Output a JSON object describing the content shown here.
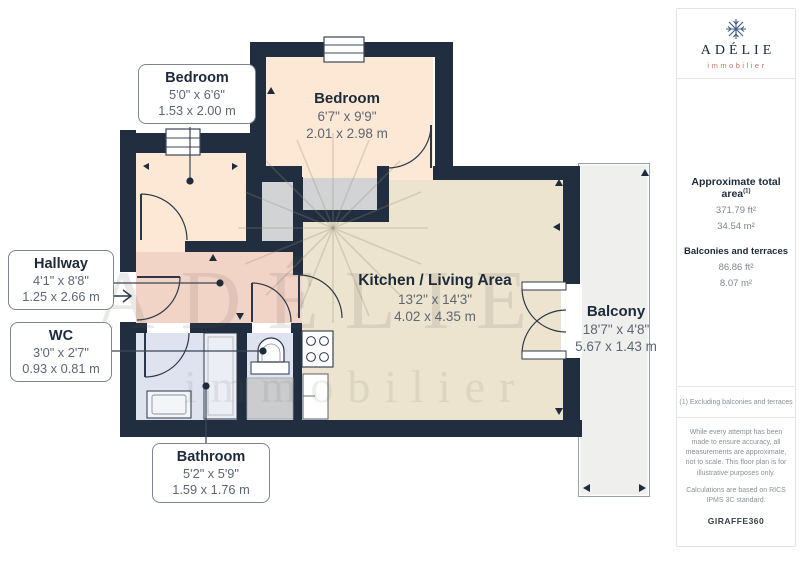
{
  "logo": {
    "name": "ADÉLIE",
    "sub": "immobilier"
  },
  "sidebar": {
    "total_area_label": "Approximate total area",
    "total_area_marker": "(1)",
    "total_area_ft": "371.79 ft²",
    "total_area_m": "34.54 m²",
    "balconies_label": "Balconies and terraces",
    "balconies_ft": "86.86 ft²",
    "balconies_m": "8.07 m²",
    "footnote": "(1) Excluding balconies and terraces",
    "disclaimer1": "While every attempt has been made to ensure accuracy, all measurements are approximate, not to scale. This floor plan is for illustrative purposes only.",
    "disclaimer2": "Calculations are based on RICS IPMS 3C standard.",
    "brand": "GIRAFFE",
    "brand_suffix": "360"
  },
  "rooms": {
    "bedroom1": {
      "name": "Bedroom",
      "imperial": "5'0\" x 6'6\"",
      "metric": "1.53 x 2.00 m"
    },
    "bedroom2": {
      "name": "Bedroom",
      "imperial": "6'7\" x 9'9\"",
      "metric": "2.01 x 2.98 m"
    },
    "hallway": {
      "name": "Hallway",
      "imperial": "4'1\" x 8'8\"",
      "metric": "1.25 x 2.66 m"
    },
    "wc": {
      "name": "WC",
      "imperial": "3'0\" x 2'7\"",
      "metric": "0.93 x 0.81 m"
    },
    "kitchen": {
      "name": "Kitchen / Living Area",
      "imperial": "13'2\" x 14'3\"",
      "metric": "4.02 x 4.35 m"
    },
    "balcony": {
      "name": "Balcony",
      "imperial": "18'7\" x 4'8\"",
      "metric": "5.67 x 1.43 m"
    },
    "bathroom": {
      "name": "Bathroom",
      "imperial": "5'2\" x 5'9\"",
      "metric": "1.59 x 1.76 m"
    }
  },
  "watermark": {
    "text": "ADÉLIE",
    "sub": "immobilier"
  },
  "colors": {
    "wall": "#212e40",
    "bedroom_fill": "#fce8d5",
    "hallway_fill": "#f2d4c7",
    "bathroom_fill": "#dfe3ef",
    "kitchen_fill": "#ece4cf",
    "closet_fill": "#d2d3d5",
    "balcony_fill": "#efefed",
    "accent_red": "#c4756a",
    "navy_text": "#1d2a3a"
  }
}
